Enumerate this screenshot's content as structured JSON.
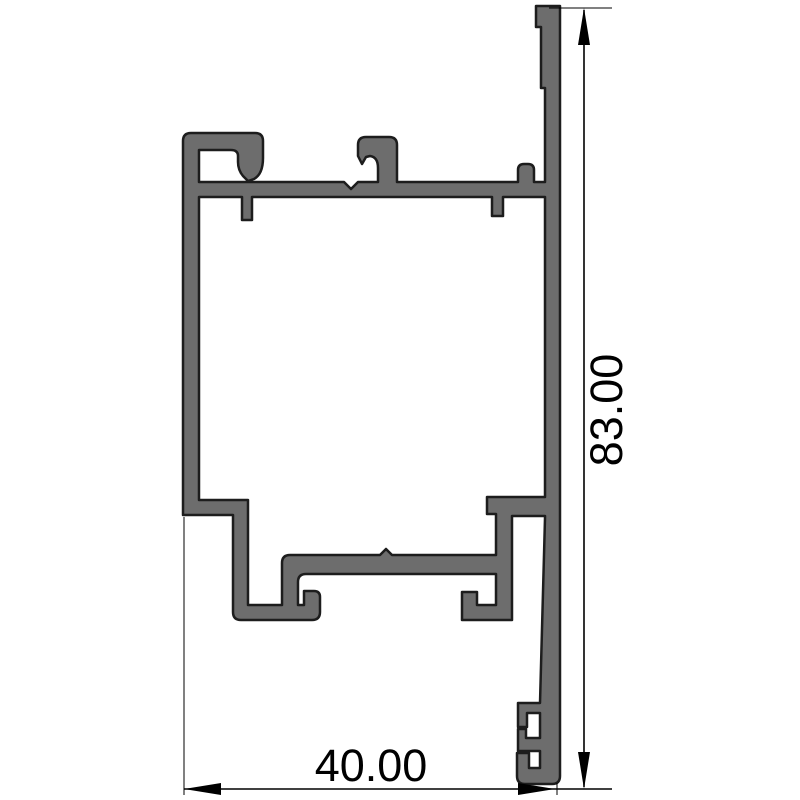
{
  "drawing": {
    "type": "technical-profile-cross-section",
    "subject": "aluminium extrusion profile",
    "background_color": "#ffffff",
    "profile": {
      "fill_color": "#6d6d6d",
      "outline_color": "#1d1d1d"
    },
    "dimensions": {
      "height": {
        "value": "83.00",
        "orientation": "vertical"
      },
      "width": {
        "value": "40.00",
        "orientation": "horizontal"
      }
    },
    "dimension_style": {
      "color": "#000000",
      "arrow_style": "filled-triangle"
    }
  }
}
